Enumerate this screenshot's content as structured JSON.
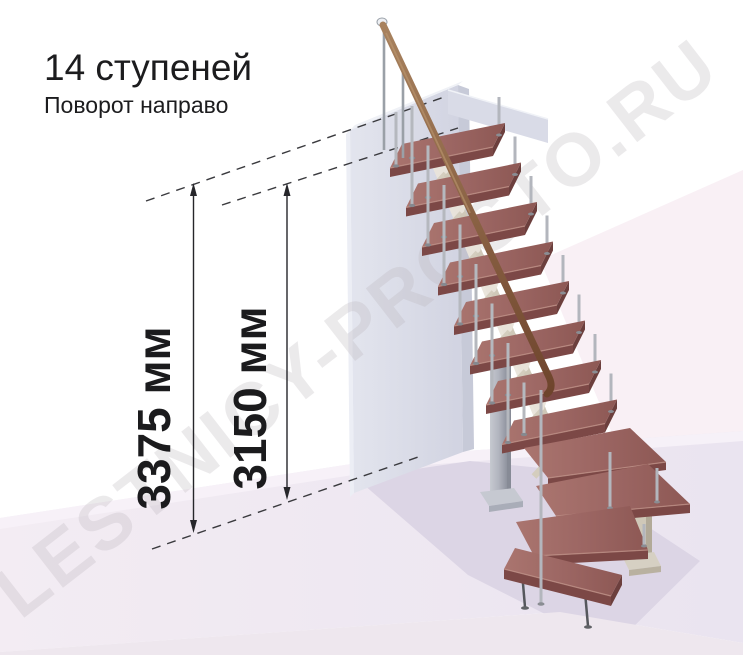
{
  "header": {
    "title": "14 ступеней",
    "subtitle": "Поворот направо"
  },
  "dimensions": {
    "overall_height": {
      "label": "3375 мм"
    },
    "to_top_step_height": {
      "label": "3150 мм"
    }
  },
  "watermark": {
    "text": "LESTNICY-PROSTO.RU"
  },
  "scene": {
    "colors": {
      "background": "#ffffff",
      "pink_wash": "#f9f0f5",
      "floor": "#efe8f2",
      "floor_shadow": "#dcd5e5",
      "wall": "#d9dbe6",
      "tread": "#9c6764",
      "tread_front": "#7c4846",
      "handrail": "#8a6247",
      "metal": "#b3b6bd",
      "frame_beige": "#d2cbbc",
      "dimension_ink": "#26262a",
      "watermark_gray": "#b9b3b9"
    }
  }
}
